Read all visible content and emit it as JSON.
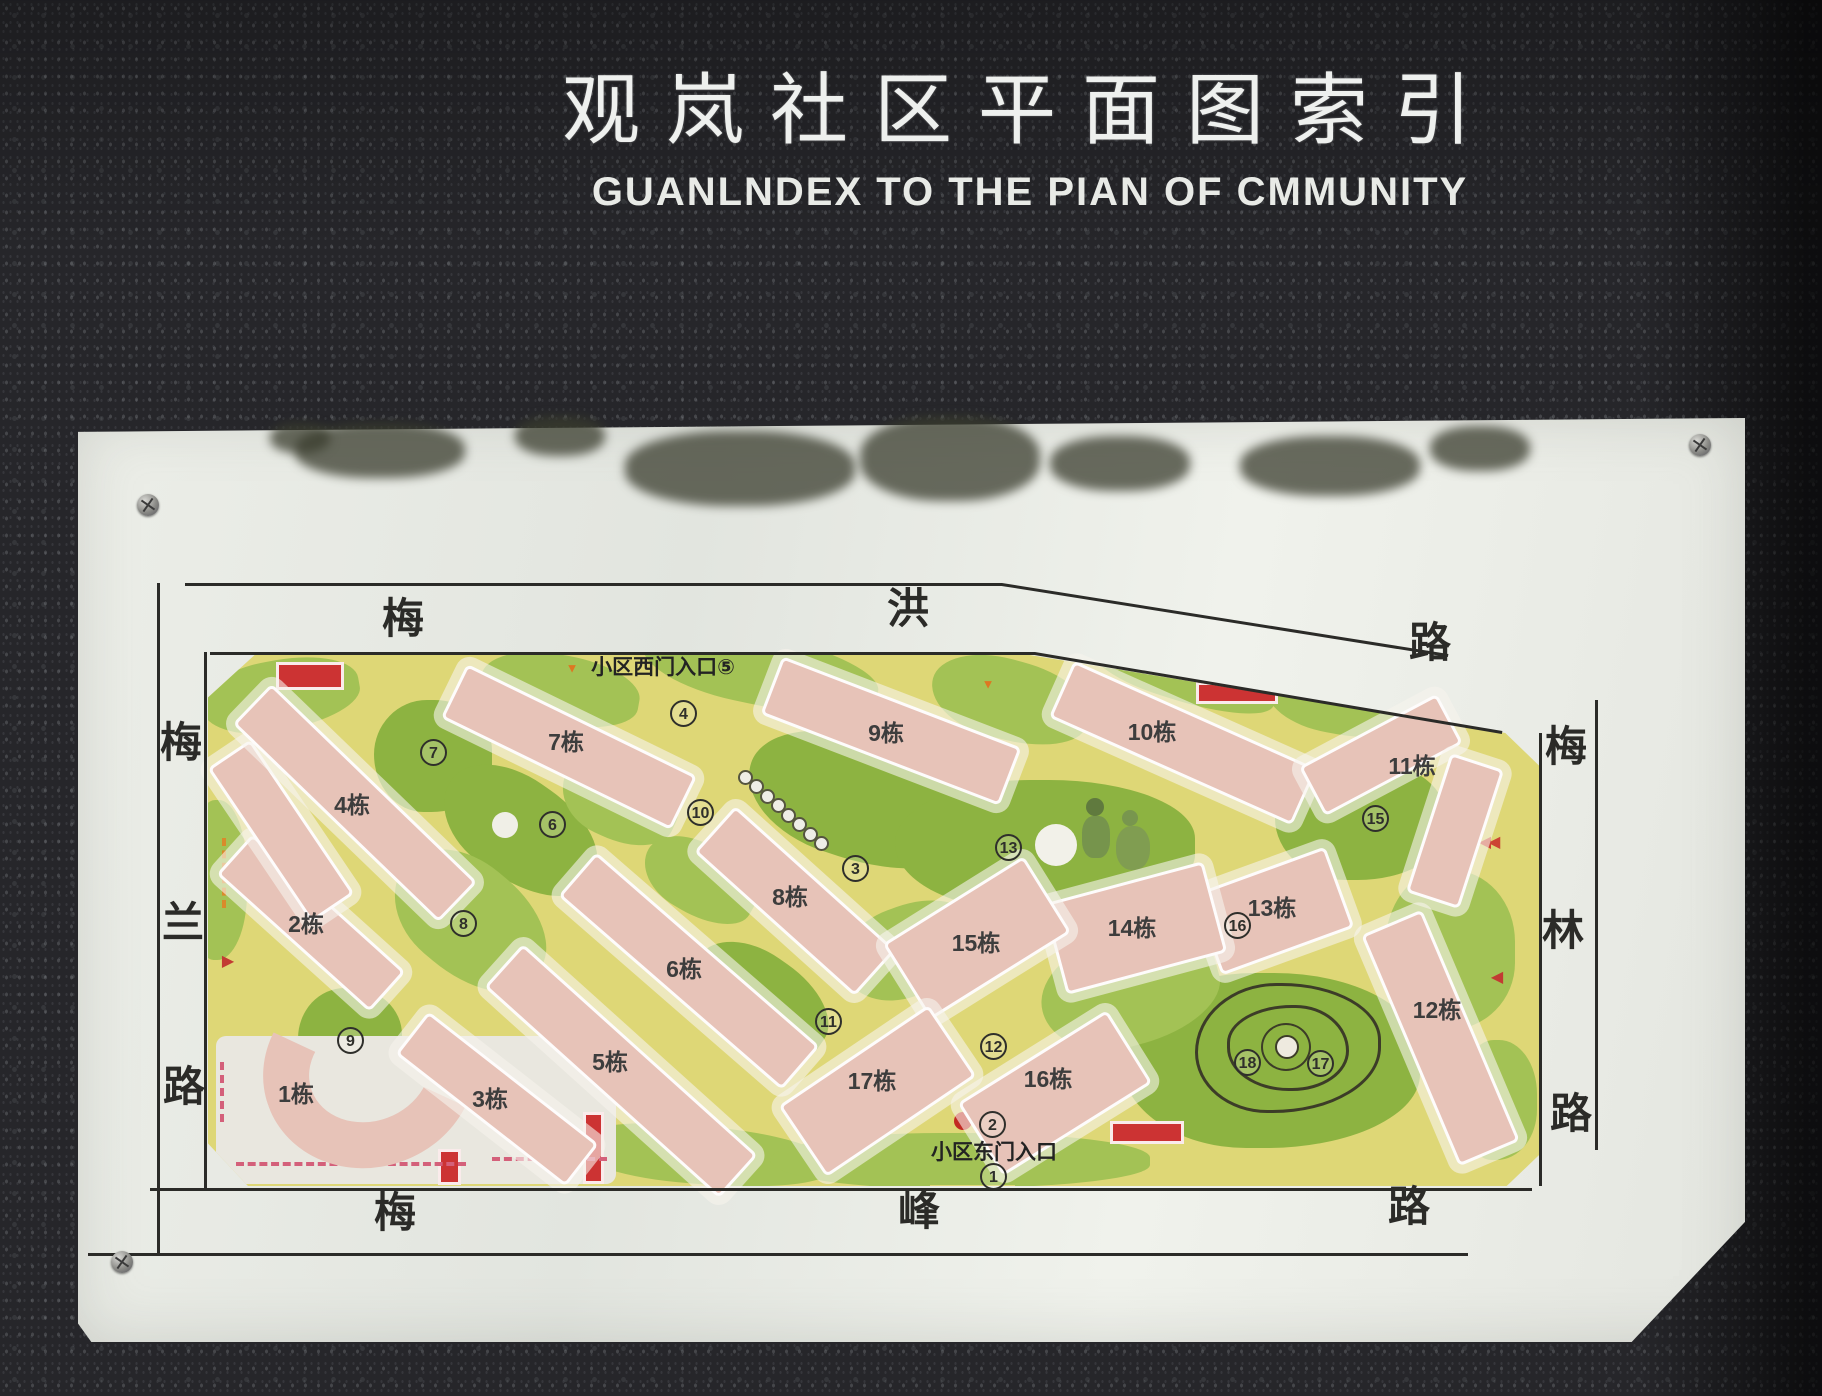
{
  "title": {
    "zh": "观岚社区平面图索引",
    "en": "GUANLNDEX TO THE PIAN OF CMMUNITY"
  },
  "colors": {
    "path_yellow": "#ded776",
    "lawn_light": "#a3c255",
    "lawn_dark": "#8db341",
    "building_pink": "#e7c3b8",
    "accent_red": "#cc3333",
    "accent_orange": "#d98a2b",
    "dash_pink": "#d4607a",
    "line_black": "#2b2b28"
  },
  "map": {
    "roads": {
      "top": {
        "name": "梅洪路",
        "chars": [
          {
            "t": "梅",
            "x": 380,
            "y": 596
          },
          {
            "t": "洪",
            "x": 885,
            "y": 586
          },
          {
            "t": "路",
            "x": 1407,
            "y": 620
          }
        ]
      },
      "left": {
        "name": "梅兰路",
        "chars": [
          {
            "t": "梅",
            "x": 158,
            "y": 720
          },
          {
            "t": "兰",
            "x": 160,
            "y": 900
          },
          {
            "t": "路",
            "x": 161,
            "y": 1064
          }
        ]
      },
      "right": {
        "name": "梅林路",
        "chars": [
          {
            "t": "梅",
            "x": 1543,
            "y": 724
          },
          {
            "t": "林",
            "x": 1540,
            "y": 908
          },
          {
            "t": "路",
            "x": 1548,
            "y": 1091
          }
        ]
      },
      "bottom": {
        "name": "梅峰路",
        "chars": [
          {
            "t": "梅",
            "x": 372,
            "y": 1190
          },
          {
            "t": "峰",
            "x": 896,
            "y": 1188
          },
          {
            "t": "路",
            "x": 1386,
            "y": 1184
          }
        ]
      }
    },
    "frame_lines": [
      {
        "x1": 185,
        "y1": 583,
        "x2": 1002,
        "y2": 583
      },
      {
        "x1": 1002,
        "y1": 583,
        "x2": 1448,
        "y2": 654
      },
      {
        "x1": 210,
        "y1": 652,
        "x2": 1035,
        "y2": 652
      },
      {
        "x1": 1035,
        "y1": 652,
        "x2": 1502,
        "y2": 731
      },
      {
        "x1": 160,
        "y1": 583,
        "x2": 160,
        "y2": 1253
      },
      {
        "x1": 207,
        "y1": 652,
        "x2": 207,
        "y2": 1188
      },
      {
        "x1": 150,
        "y1": 1188,
        "x2": 1532,
        "y2": 1188
      },
      {
        "x1": 88,
        "y1": 1253,
        "x2": 1468,
        "y2": 1253
      },
      {
        "x1": 1542,
        "y1": 733,
        "x2": 1542,
        "y2": 1186
      },
      {
        "x1": 1598,
        "y1": 700,
        "x2": 1598,
        "y2": 1150
      }
    ],
    "entrances": {
      "west": {
        "label": "小区西门入口⑤",
        "x": 663,
        "y": 666
      },
      "east": {
        "label": "小区东门入口",
        "x": 994,
        "y": 1151
      }
    },
    "buildings": [
      {
        "label": "1栋",
        "lx": 296,
        "ly": 1092,
        "arc": {
          "x": 262,
          "y": 972,
          "w": 215,
          "h": 195,
          "rot": -20
        }
      },
      {
        "label": "2栋",
        "lx": 306,
        "ly": 922,
        "slabs": [
          [
            308,
            920,
            200,
            48,
            42
          ],
          [
            278,
            828,
            180,
            46,
            56
          ]
        ]
      },
      {
        "label": "3栋",
        "lx": 490,
        "ly": 1097,
        "slabs": [
          [
            494,
            1096,
            210,
            48,
            38
          ]
        ]
      },
      {
        "label": "4栋",
        "lx": 352,
        "ly": 803,
        "slabs": [
          [
            352,
            800,
            280,
            50,
            44
          ]
        ]
      },
      {
        "label": "5栋",
        "lx": 610,
        "ly": 1060,
        "slabs": [
          [
            618,
            1068,
            310,
            52,
            42
          ]
        ]
      },
      {
        "label": "6栋",
        "lx": 684,
        "ly": 967,
        "slabs": [
          [
            686,
            968,
            290,
            52,
            41
          ]
        ]
      },
      {
        "label": "7栋",
        "lx": 566,
        "ly": 740,
        "slabs": [
          [
            566,
            744,
            250,
            54,
            26
          ]
        ]
      },
      {
        "label": "8栋",
        "lx": 790,
        "ly": 895,
        "slabs": [
          [
            792,
            898,
            210,
            56,
            42
          ]
        ]
      },
      {
        "label": "9栋",
        "lx": 886,
        "ly": 731,
        "slabs": [
          [
            888,
            728,
            250,
            56,
            21
          ]
        ]
      },
      {
        "label": "10栋",
        "lx": 1152,
        "ly": 730,
        "slabs": [
          [
            1180,
            740,
            260,
            56,
            24
          ]
        ]
      },
      {
        "label": "11栋",
        "lx": 1412,
        "ly": 764,
        "slabs": [
          [
            1378,
            752,
            150,
            50,
            -28
          ],
          [
            1452,
            828,
            140,
            50,
            -72
          ]
        ]
      },
      {
        "label": "12栋",
        "lx": 1437,
        "ly": 1008,
        "slabs": [
          [
            1437,
            1035,
            245,
            60,
            67
          ]
        ]
      },
      {
        "label": "13栋",
        "lx": 1272,
        "ly": 906,
        "slabs": [
          [
            1270,
            908,
            135,
            80,
            -20
          ]
        ]
      },
      {
        "label": "14栋",
        "lx": 1132,
        "ly": 926,
        "slabs": [
          [
            1132,
            925,
            160,
            88,
            -15
          ]
        ]
      },
      {
        "label": "15栋",
        "lx": 976,
        "ly": 941,
        "slabs": [
          [
            974,
            935,
            160,
            84,
            -32
          ]
        ]
      },
      {
        "label": "16栋",
        "lx": 1048,
        "ly": 1077,
        "slabs": [
          [
            1052,
            1090,
            170,
            80,
            -32
          ]
        ]
      },
      {
        "label": "17栋",
        "lx": 872,
        "ly": 1079,
        "slabs": [
          [
            874,
            1088,
            175,
            80,
            -34
          ]
        ]
      }
    ],
    "markers": [
      {
        "n": "1",
        "x": 993,
        "y": 1176
      },
      {
        "n": "2",
        "x": 992,
        "y": 1124
      },
      {
        "n": "3",
        "x": 855,
        "y": 868
      },
      {
        "n": "4",
        "x": 683,
        "y": 713
      },
      {
        "n": "6",
        "x": 552,
        "y": 824
      },
      {
        "n": "7",
        "x": 433,
        "y": 752
      },
      {
        "n": "8",
        "x": 463,
        "y": 923
      },
      {
        "n": "9",
        "x": 350,
        "y": 1040
      },
      {
        "n": "10",
        "x": 700,
        "y": 812
      },
      {
        "n": "11",
        "x": 828,
        "y": 1021
      },
      {
        "n": "12",
        "x": 993,
        "y": 1046
      },
      {
        "n": "13",
        "x": 1008,
        "y": 847
      },
      {
        "n": "15",
        "x": 1375,
        "y": 818
      },
      {
        "n": "16",
        "x": 1237,
        "y": 925
      },
      {
        "n": "17",
        "x": 1320,
        "y": 1063
      },
      {
        "n": "18",
        "x": 1247,
        "y": 1062
      }
    ],
    "lawns": [
      {
        "x": 280,
        "y": 695,
        "w": 160,
        "h": 70,
        "rot": -10,
        "dark": false
      },
      {
        "x": 560,
        "y": 690,
        "w": 160,
        "h": 70,
        "rot": 10,
        "dark": false
      },
      {
        "x": 433,
        "y": 756,
        "w": 118,
        "h": 112,
        "rot": 0,
        "dark": true
      },
      {
        "x": 520,
        "y": 830,
        "w": 170,
        "h": 100,
        "rot": 35,
        "dark": true
      },
      {
        "x": 620,
        "y": 800,
        "w": 120,
        "h": 80,
        "rot": 25,
        "dark": false
      },
      {
        "x": 760,
        "y": 670,
        "w": 240,
        "h": 70,
        "rot": 12,
        "dark": false
      },
      {
        "x": 860,
        "y": 800,
        "w": 230,
        "h": 120,
        "rot": 18,
        "dark": true
      },
      {
        "x": 1010,
        "y": 700,
        "w": 160,
        "h": 80,
        "rot": 15,
        "dark": false
      },
      {
        "x": 1045,
        "y": 845,
        "w": 300,
        "h": 130,
        "rot": 0,
        "dark": true
      },
      {
        "x": 1180,
        "y": 670,
        "w": 200,
        "h": 60,
        "rot": 18,
        "dark": false
      },
      {
        "x": 1345,
        "y": 700,
        "w": 160,
        "h": 70,
        "rot": 10,
        "dark": false
      },
      {
        "x": 1360,
        "y": 820,
        "w": 170,
        "h": 120,
        "rot": 0,
        "dark": true
      },
      {
        "x": 1450,
        "y": 950,
        "w": 130,
        "h": 160,
        "rot": 0,
        "dark": false
      },
      {
        "x": 470,
        "y": 920,
        "w": 170,
        "h": 110,
        "rot": 40,
        "dark": false
      },
      {
        "x": 350,
        "y": 1040,
        "w": 104,
        "h": 104,
        "rot": 0,
        "dark": true
      },
      {
        "x": 700,
        "y": 880,
        "w": 120,
        "h": 70,
        "rot": 30,
        "dark": false
      },
      {
        "x": 700,
        "y": 1155,
        "w": 260,
        "h": 58,
        "rot": 5,
        "dark": false
      },
      {
        "x": 760,
        "y": 1000,
        "w": 150,
        "h": 90,
        "rot": 35,
        "dark": true
      },
      {
        "x": 960,
        "y": 1160,
        "w": 380,
        "h": 55,
        "rot": 0,
        "dark": false
      },
      {
        "x": 1270,
        "y": 1060,
        "w": 300,
        "h": 175,
        "rot": 0,
        "dark": true
      },
      {
        "x": 1130,
        "y": 990,
        "w": 180,
        "h": 110,
        "rot": -15,
        "dark": false
      },
      {
        "x": 910,
        "y": 950,
        "w": 140,
        "h": 90,
        "rot": -20,
        "dark": false
      },
      {
        "x": 218,
        "y": 880,
        "w": 58,
        "h": 160,
        "rot": 0,
        "dark": false
      },
      {
        "x": 1498,
        "y": 1100,
        "w": 78,
        "h": 120,
        "rot": 0,
        "dark": false
      }
    ],
    "features": {
      "white_patch": {
        "x": 216,
        "y": 1036,
        "w": 400,
        "h": 148
      },
      "east_path_stub": {
        "x": 930,
        "y": 1185,
        "w": 85,
        "h": 28
      },
      "red_rects": [
        {
          "x": 276,
          "y": 662,
          "w": 62,
          "h": 22
        },
        {
          "x": 1196,
          "y": 682,
          "w": 76,
          "h": 16
        },
        {
          "x": 1110,
          "y": 1121,
          "w": 68,
          "h": 17
        },
        {
          "x": 438,
          "y": 1149,
          "w": 17,
          "h": 30
        },
        {
          "x": 583,
          "y": 1112,
          "w": 15,
          "h": 66
        }
      ],
      "dark_green_rects": [
        {
          "x": 1046,
          "y": 915,
          "w": 24,
          "h": 10
        }
      ],
      "red_dot": {
        "x": 963,
        "y": 1121,
        "r": 9
      },
      "pond": {
        "x": 1056,
        "y": 845,
        "r": 21
      },
      "small_circle": {
        "x": 505,
        "y": 825,
        "r": 13
      },
      "mound": {
        "x": 1285,
        "y": 1045
      },
      "children_illustration": {
        "x": 1112,
        "y": 828
      },
      "dotted_trail": {
        "x1": 744,
        "y1": 776,
        "x2": 820,
        "y2": 842,
        "n": 8
      },
      "arrows": [
        {
          "x": 228,
          "y": 962,
          "dir": "right",
          "c": "#c23b33"
        },
        {
          "x": 1497,
          "y": 978,
          "dir": "left",
          "c": "#c23b33"
        },
        {
          "x": 1488,
          "y": 843,
          "dir": "left2",
          "c": "#cc4433"
        },
        {
          "x": 572,
          "y": 668,
          "dir": "down",
          "c": "#dd7722"
        },
        {
          "x": 988,
          "y": 684,
          "dir": "down",
          "c": "#dd7722"
        }
      ],
      "dashes": [
        {
          "x": 222,
          "y": 838,
          "len": 70,
          "dir": "v",
          "c": "#d98a2b"
        },
        {
          "x": 220,
          "y": 1062,
          "len": 60,
          "dir": "v",
          "c": "#d4607a"
        },
        {
          "x": 236,
          "y": 1162,
          "len": 230,
          "dir": "h",
          "c": "#d4607a"
        },
        {
          "x": 492,
          "y": 1157,
          "len": 115,
          "dir": "h",
          "c": "#d4607a"
        }
      ]
    },
    "screws": [
      {
        "x": 148,
        "y": 505
      },
      {
        "x": 1700,
        "y": 445
      },
      {
        "x": 122,
        "y": 1262
      }
    ],
    "grunge": [
      {
        "x": 380,
        "y": 450,
        "w": 170,
        "h": 55
      },
      {
        "x": 560,
        "y": 436,
        "w": 90,
        "h": 40
      },
      {
        "x": 740,
        "y": 468,
        "w": 230,
        "h": 75
      },
      {
        "x": 950,
        "y": 458,
        "w": 180,
        "h": 85
      },
      {
        "x": 1120,
        "y": 463,
        "w": 140,
        "h": 55
      },
      {
        "x": 1330,
        "y": 466,
        "w": 180,
        "h": 60
      },
      {
        "x": 1480,
        "y": 448,
        "w": 100,
        "h": 45
      },
      {
        "x": 300,
        "y": 438,
        "w": 60,
        "h": 30
      }
    ]
  }
}
